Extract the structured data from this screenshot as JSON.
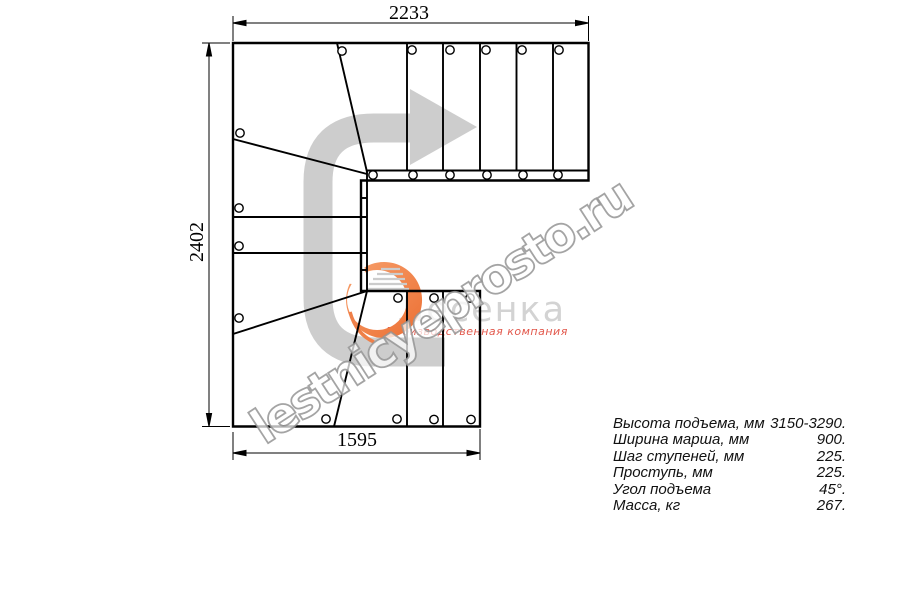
{
  "plan": {
    "dims": {
      "top": "2233",
      "left": "2402",
      "bottom": "1595"
    },
    "direction_arrow_icon": "u-turn-right-arrow",
    "colors": {
      "line": "#000000",
      "arrow_gray": "#cdcdcd",
      "background": "#ffffff"
    }
  },
  "brand": {
    "logo_text": "Лесенка",
    "logo_icon": "crescent-stairs-icon",
    "tagline": "Производственная компания",
    "colors": {
      "logo_orange": "#ec6f33",
      "logo_orange_light": "#f7a06c",
      "logo_gray": "#d3d3d3",
      "tagline_red": "#e2574b"
    }
  },
  "watermark": {
    "text": "lestnicyeprosto.ru",
    "color": "#969696"
  },
  "specs": {
    "rows": [
      {
        "label": "Высота подъема, мм",
        "value": "3150-3290."
      },
      {
        "label": "Ширина марша, мм",
        "value": "900."
      },
      {
        "label": "Шаг ступеней, мм",
        "value": "225."
      },
      {
        "label": "Проступь, мм",
        "value": "225."
      },
      {
        "label": "Угол подъема",
        "value": "45°."
      },
      {
        "label": "Масса, кг",
        "value": "267."
      }
    ]
  }
}
